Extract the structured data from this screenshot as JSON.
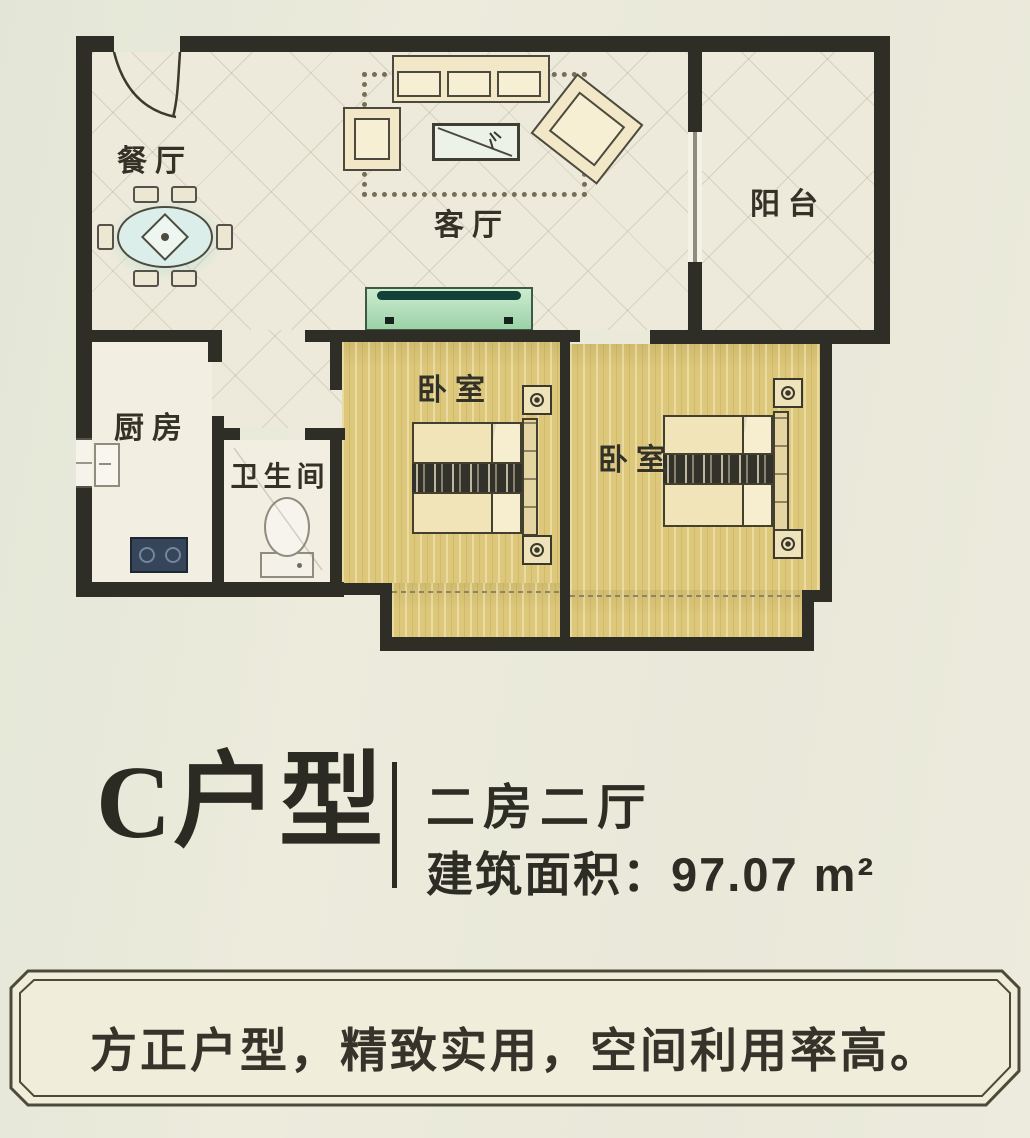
{
  "plan": {
    "rooms": {
      "dining": "餐厅",
      "living": "客厅",
      "balcony": "阳台",
      "kitchen": "厨房",
      "bathroom": "卫生间",
      "bedroom_left": "卧室",
      "bedroom_right": "卧室"
    },
    "furniture_symbols": [
      "dining-table",
      "sofa-set",
      "coffee-table",
      "tv-stand",
      "kitchen-sink",
      "stove",
      "toilet",
      "double-bed",
      "nightstand",
      "entry-door",
      "sliding-door",
      "window"
    ]
  },
  "title_block": {
    "unit_name": "C户型",
    "layout": "二房二厅",
    "area_label": "建筑面积：97.07 m²"
  },
  "banner": {
    "slogan": "方正户型，精致实用，空间利用率高。"
  },
  "colors": {
    "wall": "#2f2e26",
    "floor-cream": "#eeeadb",
    "floor-wood": "#dcc77a",
    "accent-teal": "#9fd8b5",
    "text": "#32312a"
  }
}
